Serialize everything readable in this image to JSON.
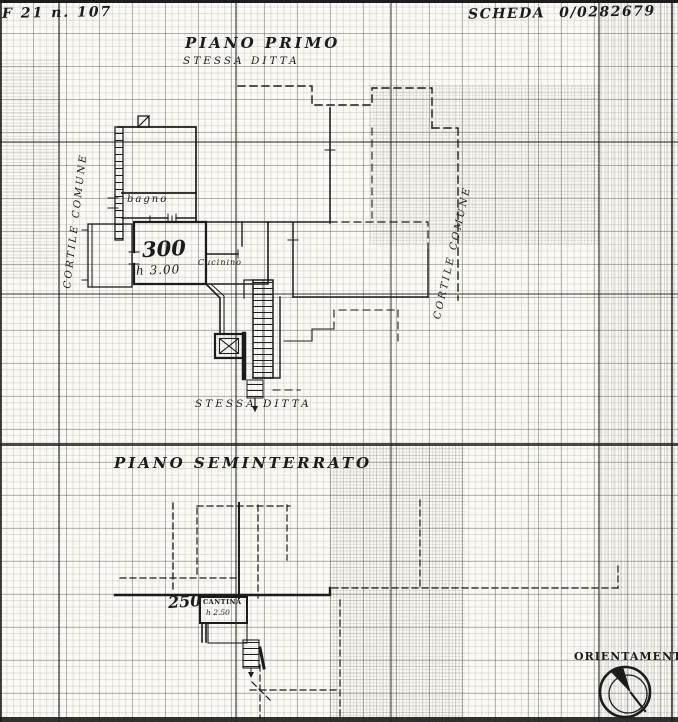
{
  "header": {
    "map_ref": "F 21 n. 107",
    "scheda_label": "SCHEDA",
    "scheda_number": "0/0282679"
  },
  "first_floor": {
    "title": "PIANO PRIMO",
    "subtitle": "STESSA DITTA",
    "bottom_note": "STESSA DITTA",
    "rooms": {
      "bagno": "bagno",
      "cucinino": "Cucinino",
      "area_value": "300",
      "height_note": "h 3.00"
    }
  },
  "basement": {
    "title": "PIANO SEMINTERRATO",
    "rooms": {
      "cantina": "CANTINA",
      "area_value": "250",
      "height_note": "h 2.50"
    }
  },
  "courtyards": {
    "left": "CORTILE COMUNE",
    "right": "CORTILE COMUNE"
  },
  "orientation": {
    "label": "ORIENTAMENTO",
    "icon": "compass-needle-icon"
  },
  "colors": {
    "ink": "#1c1c1c",
    "paper": "#fbfaf6"
  }
}
